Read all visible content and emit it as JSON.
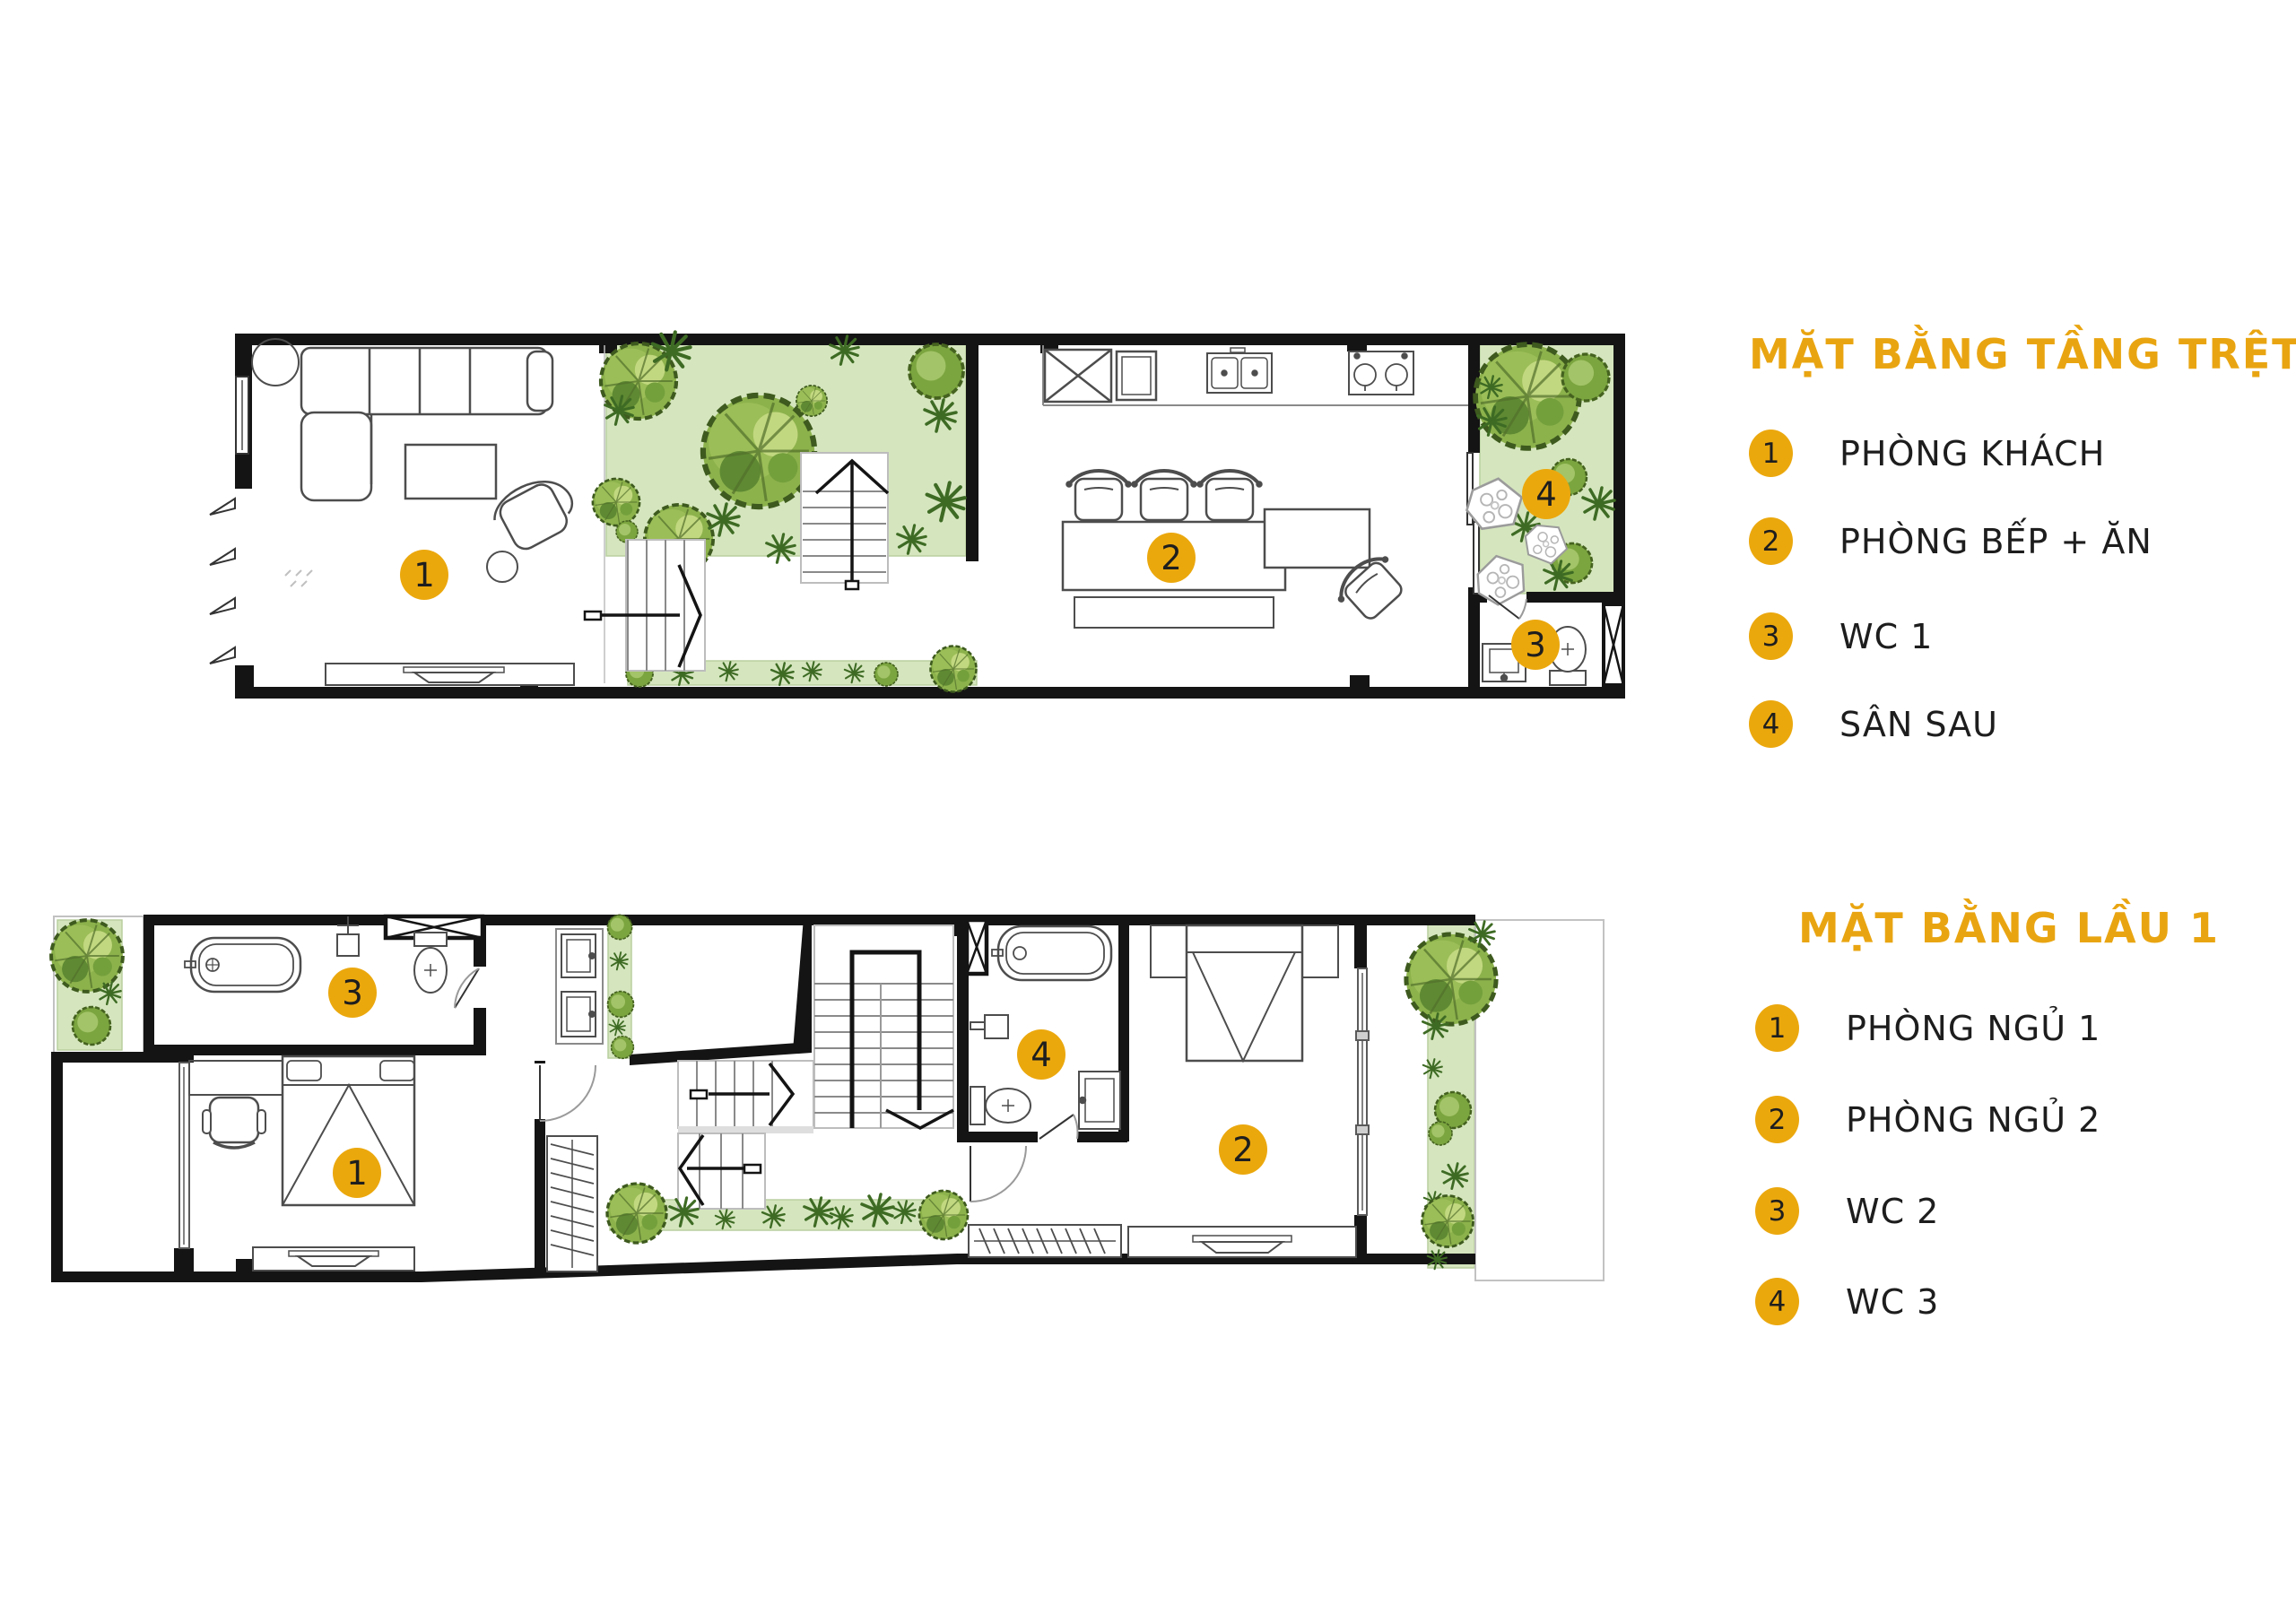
{
  "colors": {
    "accent": "#EBA80D",
    "title_text": "#E9A511",
    "wall": "#141414",
    "garden_green": "#D5E6BE",
    "tree_green": "#8CB24C",
    "label_text": "#1D1D1D"
  },
  "ground_floor": {
    "title": "MẶT BẰNG TẦNG TRỆT",
    "legend": [
      {
        "num": "1",
        "label": "PHÒNG KHÁCH"
      },
      {
        "num": "2",
        "label": "PHÒNG BẾP + ĂN"
      },
      {
        "num": "3",
        "label": "WC 1"
      },
      {
        "num": "4",
        "label": "SÂN SAU"
      }
    ],
    "markers": {
      "living_room": "1",
      "kitchen_dining": "2",
      "wc1": "3",
      "backyard": "4"
    }
  },
  "first_floor": {
    "title": "MẶT BẰNG LẦU 1",
    "legend": [
      {
        "num": "1",
        "label": "PHÒNG NGỦ 1"
      },
      {
        "num": "2",
        "label": "PHÒNG NGỦ 2"
      },
      {
        "num": "3",
        "label": "WC 2"
      },
      {
        "num": "4",
        "label": "WC 3"
      }
    ],
    "markers": {
      "bedroom1": "1",
      "bedroom2": "2",
      "wc2": "3",
      "wc3": "4"
    }
  }
}
